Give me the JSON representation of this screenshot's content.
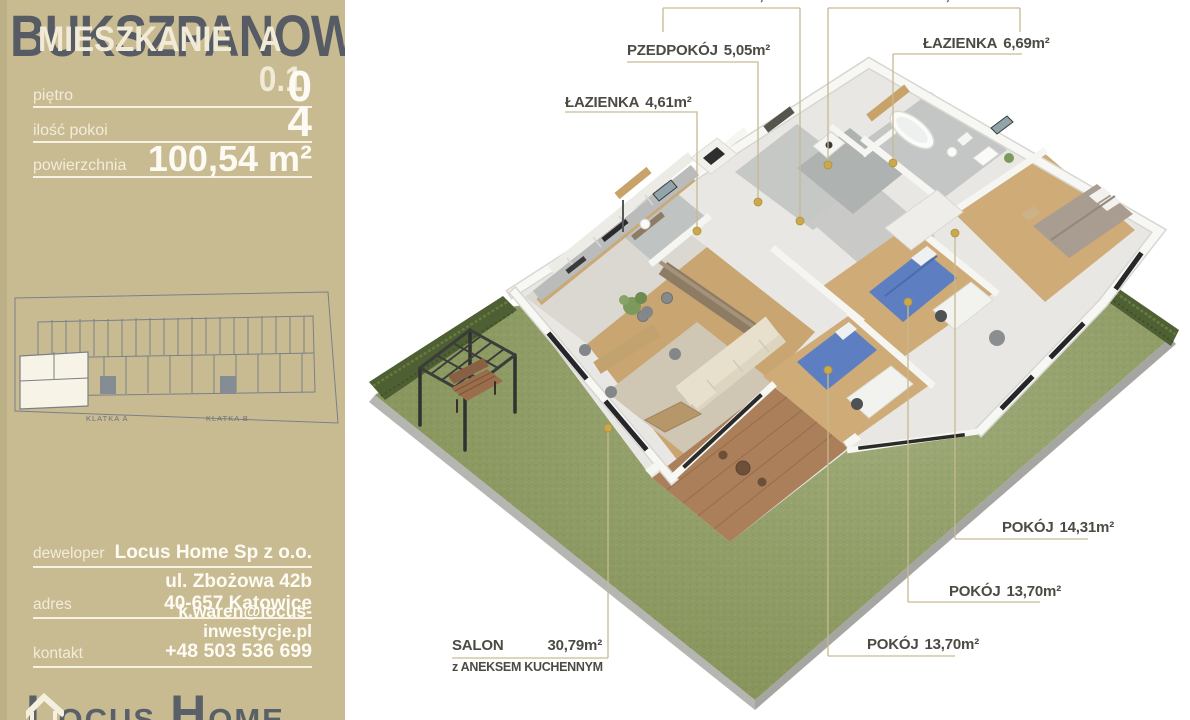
{
  "sidebar": {
    "project_title": "BUKSZPANOWA",
    "unit_label": "MIESZKANIE",
    "unit_number": "A 0.1",
    "specs": [
      {
        "label": "piętro",
        "value": "0"
      },
      {
        "label": "ilość pokoi",
        "value": "4"
      },
      {
        "label": "powierzchnia",
        "value": "100,54 m²"
      }
    ],
    "site_plan": {
      "klatka_a": "KLATKA A",
      "klatka_b": "KLATKA B"
    },
    "contact": [
      {
        "label": "deweloper",
        "lines": [
          "Locus Home Sp z o.o."
        ]
      },
      {
        "label": "adres",
        "lines": [
          "ul. Zbożowa 42b",
          "40-657 Katowice"
        ]
      },
      {
        "label": "kontakt",
        "lines": [
          "k.waren@locus-inwestycje.pl",
          "+48 503 536 699"
        ]
      }
    ],
    "logo": {
      "text1": "L",
      "text2": "OCUS",
      "text3": "H",
      "text4": "OME"
    }
  },
  "floor_plan": {
    "rooms": [
      {
        "name": "KORYTARZ",
        "area": "9,43m²"
      },
      {
        "name": "PRALNIA",
        "area": "2,26m²"
      },
      {
        "name": "PZEDPOKÓJ",
        "area": "5,05m²"
      },
      {
        "name": "ŁAZIENKA",
        "area": "4,61m²"
      },
      {
        "name": "ŁAZIENKA",
        "area": "6,69m²"
      },
      {
        "name": "POKÓJ",
        "area": "14,31m²"
      },
      {
        "name": "POKÓJ",
        "area": "13,70m²"
      },
      {
        "name": "POKÓJ",
        "area": "13,70m²"
      },
      {
        "name": "SALON",
        "area": "30,79m²",
        "suffix": "z ANEKSEM KUCHENNYM"
      }
    ]
  },
  "colors": {
    "sidebar_bg": "#c8bb92",
    "title_dark": "#575c64",
    "cream_text": "#f1ead7",
    "white_text": "#fdfbf3",
    "label_dark": "#4c4b43",
    "leader_line": "#c6ba92",
    "marker_gold": "#c9a84e",
    "lawn_green": "#8e9c60",
    "hedge_green": "#4e5f33",
    "wood_floor": "#c8a571",
    "deck_wood": "#aa7f5a"
  }
}
